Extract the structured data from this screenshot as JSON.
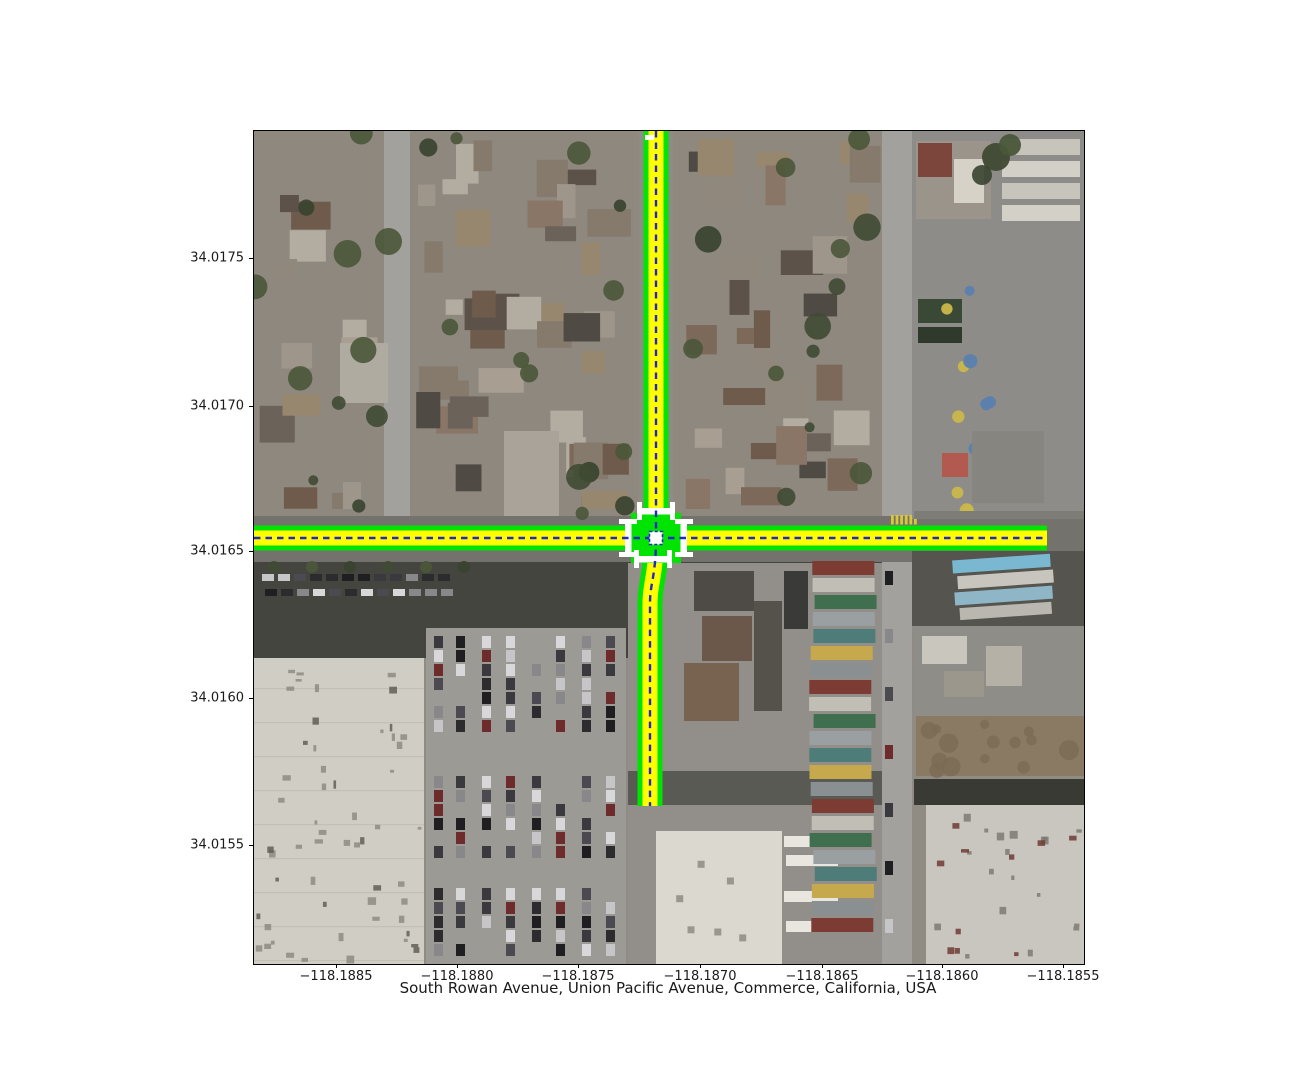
{
  "figure": {
    "type": "matplotlib-style map figure",
    "title": "South Rowan Avenue, Union Pacific Avenue, Commerce, California, USA",
    "background": "#ffffff"
  },
  "axes": {
    "x_tick_labels": [
      "−118.1885",
      "−118.1880",
      "−118.1875",
      "−118.1870",
      "−118.1865",
      "−118.1860",
      "−118.1855"
    ],
    "y_tick_labels": [
      "34.0175",
      "34.0170",
      "34.0165",
      "34.0160",
      "34.0155"
    ],
    "tick_color": "#000000"
  },
  "map": {
    "description": "Aerial satellite imagery with a lane-level road-network overlay centered on an urban intersection",
    "overlay": {
      "lane_edge_color": "#00e400",
      "lane_fill_color": "#ffff00",
      "centerline_color": "#2525cd",
      "centerline_style": "dashed",
      "marking_color": "#ffffff",
      "roads": [
        {
          "id": "union-pacific-avenue",
          "label": "Union Pacific Avenue",
          "orientation": "east-west"
        },
        {
          "id": "south-rowan-avenue-north-leg",
          "label": "South Rowan Avenue (north leg)",
          "orientation": "north-south"
        },
        {
          "id": "south-rowan-avenue-south-leg",
          "label": "South Rowan Avenue (south leg)",
          "orientation": "north-south"
        }
      ],
      "intersection": {
        "crosswalk_markings": 4,
        "center_node_marker": true
      }
    },
    "scenery": {
      "base_color": "#918c83",
      "residential_roof_palette": [
        "#6f5b4b",
        "#7d695a",
        "#8a7666",
        "#97876f",
        "#5c524a",
        "#9e968a",
        "#b3aca0",
        "#4f4a44",
        "#857a6c",
        "#a89f92",
        "#6b635a",
        "#90887c"
      ],
      "tree_palette": [
        "#3f4a33",
        "#4a5639",
        "#37422e"
      ],
      "street_color": "#a3a19d",
      "asphalt_color": "#74726d",
      "warehouse_color": "#d0cdc5",
      "warehouse_right_color": "#c9c6bf",
      "parking_lot_color": "#9c9a94",
      "car_palette": [
        "#2c2c2e",
        "#3a3a3e",
        "#c6c6c8",
        "#88888a",
        "#1f1f22",
        "#6e2b2c",
        "#4a4a50",
        "#d8d8da"
      ],
      "container_palette": [
        "#7c3b33",
        "#c1beb6",
        "#3f6f4f",
        "#9aa0a2",
        "#4e7c78",
        "#c7a94d",
        "#8a8f92"
      ],
      "dirt_color": "#8a7a64",
      "shadow_color": "#45453f",
      "school_asphalt": "#8e8c88",
      "playground_dot_colors": [
        "#c9b84a",
        "#5b7fae"
      ],
      "white_building_color": "#dbd8d0",
      "yellow_crosswalk_color": "#d8c835"
    }
  }
}
